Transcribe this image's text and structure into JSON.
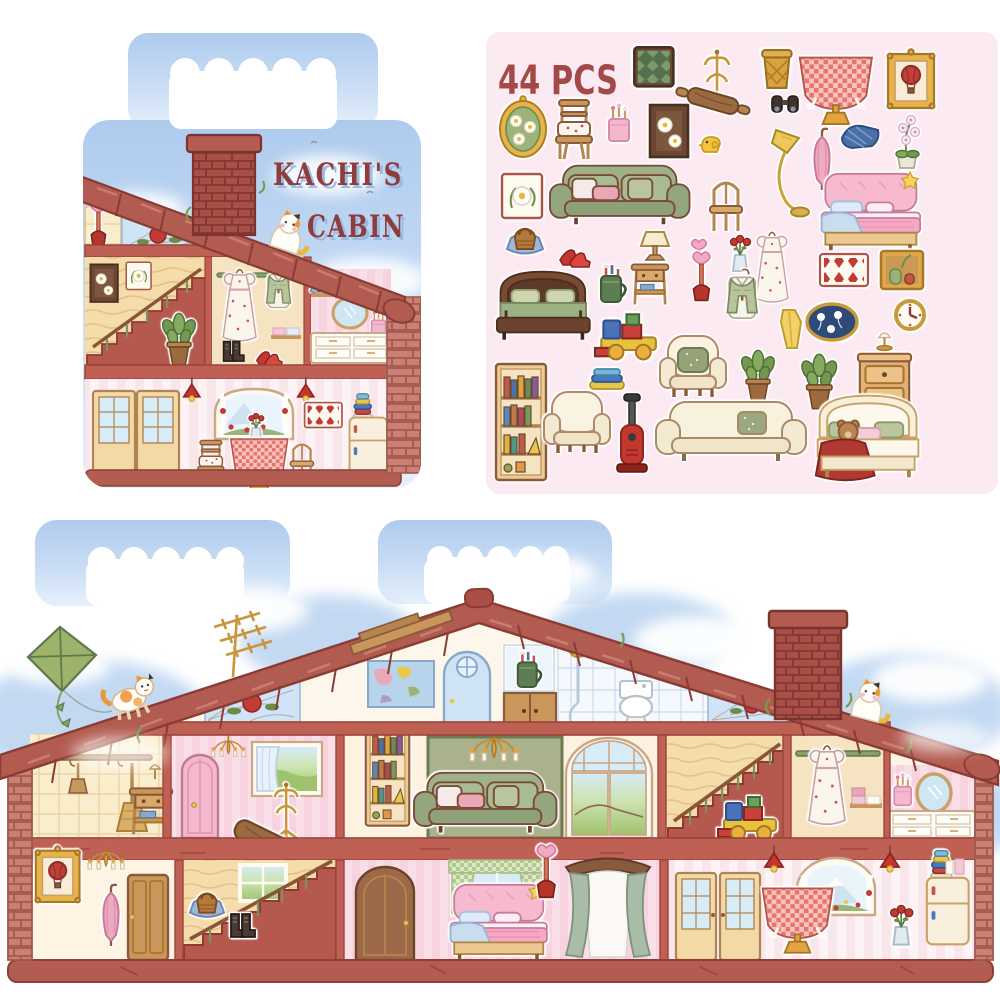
{
  "product": {
    "title_line1": "KACHI'S",
    "title_line2": "CABIN",
    "count_label": "44 PCS"
  },
  "colors": {
    "roof": "#b25b50",
    "roof_outline": "#8a3c34",
    "brick": "#c98175",
    "floor_band": "#bf6054",
    "sky": "#b0cdf0",
    "sticker_sheet_bg": "#fceaf3",
    "title_text": "#8e3d3c",
    "count_text": "#a34a48",
    "wall_pink": "#fbdfe8",
    "wall_cream": "#fdf4e4",
    "wood": "#f5dcab",
    "sofa_green": "#9fb188",
    "accent_red": "#c23b35"
  },
  "carry_case": {
    "rooms": [
      "attic with stained-glass rose",
      "staircase room",
      "wardrobe room",
      "vanity room",
      "dining room"
    ],
    "details": [
      "brick chimney",
      "calico cat on roof",
      "heart plunger",
      "kite-free sky",
      "pendant lamps",
      "gingham table"
    ]
  },
  "sticker_sheet": {
    "items": [
      "green-check rug",
      "coat rack",
      "woven basket",
      "gingham tablecloth table",
      "hot-air-balloon frame",
      "oval flower frame",
      "cushion chair",
      "brush cup",
      "daisy painting",
      "rolling pin",
      "binoculars",
      "rubber duck",
      "floor lamp",
      "pink umbrella",
      "plaid blanket",
      "orchid pot",
      "daisy frame",
      "green sofa",
      "wooden chair",
      "pink bed",
      "straw handbag",
      "red heels",
      "table lamp",
      "heart wand",
      "rose vase",
      "white floral dress",
      "diamond wall rug",
      "vase cabinet",
      "green wooden bed",
      "toothbrush mug",
      "nightstand",
      "heart plunger",
      "knit vest outfit",
      "yellow towel",
      "oval daisy art",
      "wall clock",
      "toy block truck",
      "towel stack",
      "armchair with green pillow",
      "potted plant",
      "monstera pot",
      "dresser with lamp",
      "bookshelf",
      "white armchair",
      "vacuum cleaner",
      "white sofa",
      "teddy bear bed"
    ]
  },
  "house": {
    "exterior": [
      "green kite",
      "tv antenna",
      "orange cat on roof",
      "wood plank",
      "brick chimney",
      "white cat on roof",
      "stained glass roses"
    ],
    "attic": [
      "world map",
      "blue round-window door",
      "toothbrush mug niche",
      "wooden cupboard",
      "shower",
      "toilet"
    ],
    "middle_floor": [
      "broom nook",
      "pink bedroom",
      "living room",
      "staircase with toy truck",
      "wardrobe",
      "vanity corner"
    ],
    "ground_floor": [
      "entry hall",
      "staircase with handbag and boots",
      "pink bedroom with canopy",
      "dining kitchen"
    ]
  }
}
